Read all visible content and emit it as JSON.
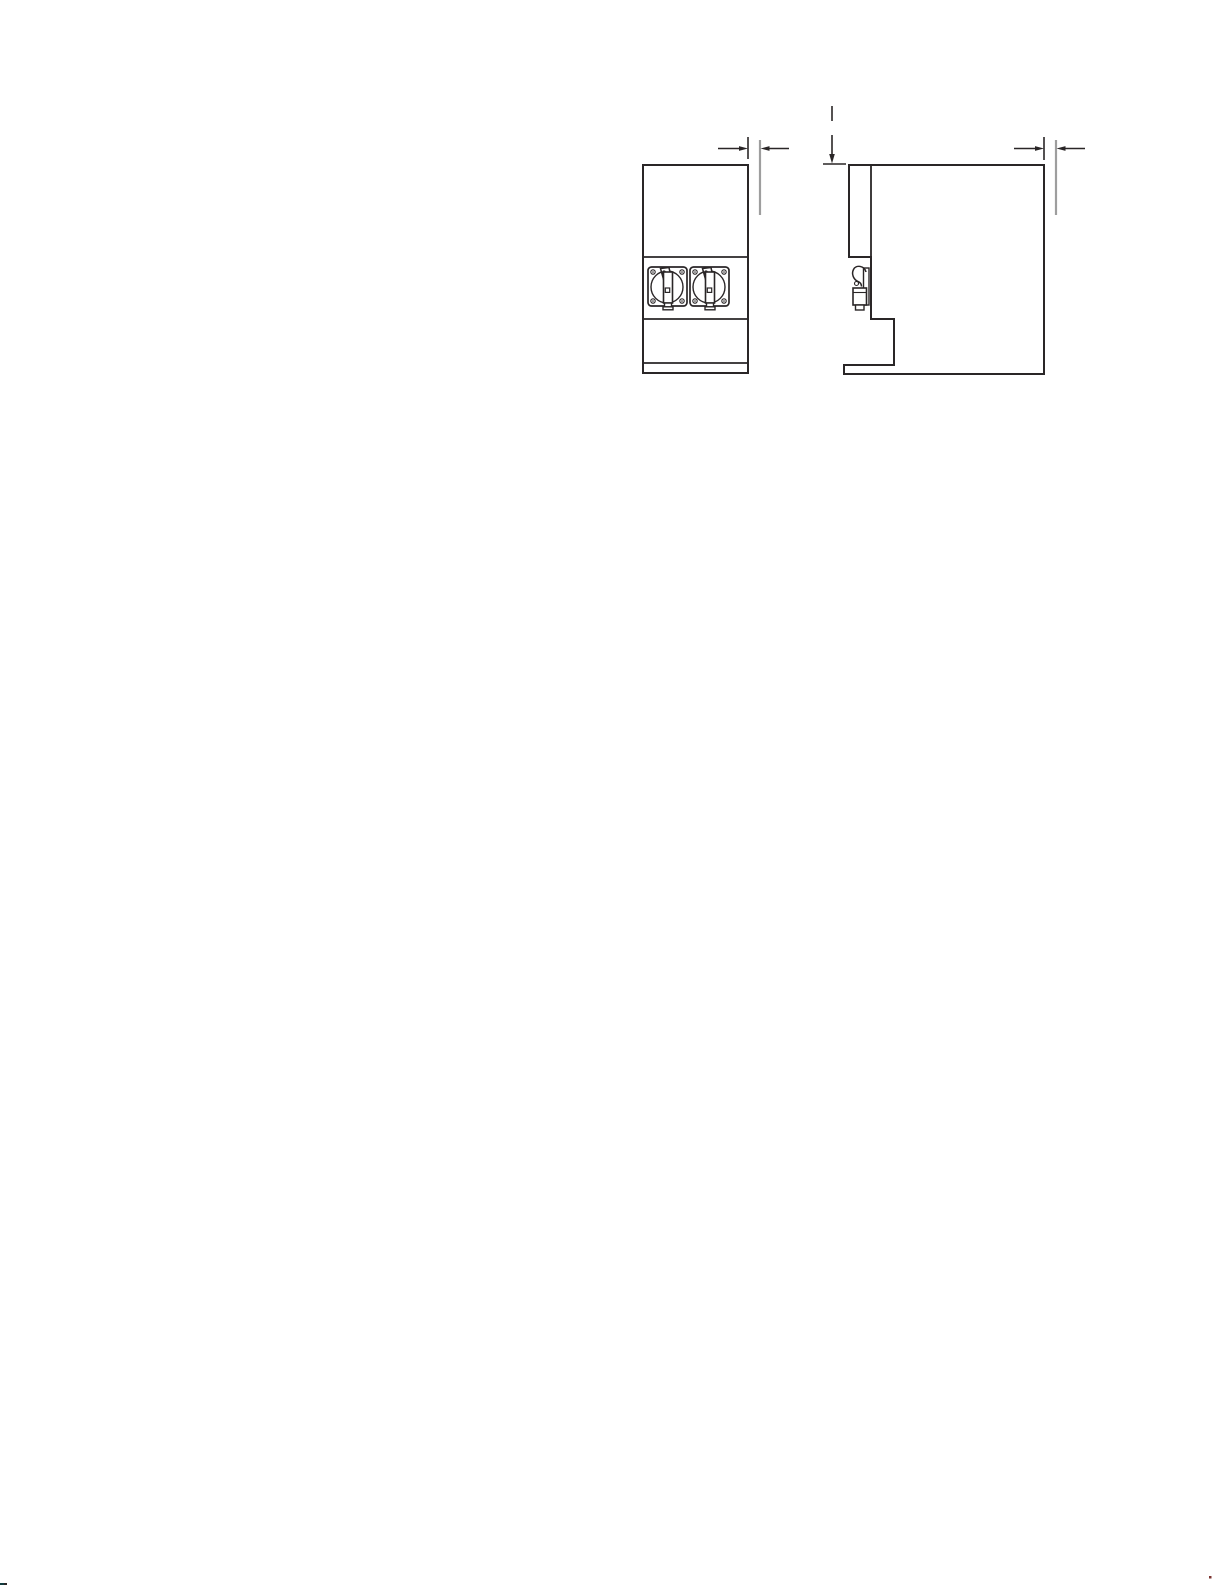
{
  "page": {
    "width": 1225,
    "height": 1585,
    "background": "#ffffff"
  },
  "drawing": {
    "ink": "#2a2627",
    "extension_gray": "#9e9e9e",
    "defs": {
      "valve": [
        {
          "t": "rect",
          "x": 0,
          "y": 0,
          "w": 39,
          "h": 39,
          "rx": 3.5,
          "f": "#ffffff",
          "sw": 1.7,
          "name": "valve-faceplate"
        },
        {
          "t": "circle",
          "cx": 19,
          "cy": 20,
          "r": 16,
          "f": "none",
          "sw": 1.4,
          "name": "valve-bezel"
        },
        {
          "t": "circle",
          "cx": 5,
          "cy": 5,
          "r": 2.2,
          "f": "none",
          "sw": 1.1,
          "name": "screw"
        },
        {
          "t": "circle",
          "cx": 34,
          "cy": 5,
          "r": 2.2,
          "f": "none",
          "sw": 1.1,
          "name": "screw"
        },
        {
          "t": "circle",
          "cx": 5,
          "cy": 34,
          "r": 2.2,
          "f": "none",
          "sw": 1.1,
          "name": "screw"
        },
        {
          "t": "circle",
          "cx": 34,
          "cy": 34,
          "r": 2.2,
          "f": "none",
          "sw": 1.1,
          "name": "screw"
        },
        {
          "t": "circle",
          "cx": 5,
          "cy": 5,
          "r": 0.8,
          "f": "#2a2627",
          "sw": 0,
          "name": "screw-dot"
        },
        {
          "t": "circle",
          "cx": 34,
          "cy": 5,
          "r": 0.8,
          "f": "#2a2627",
          "sw": 0,
          "name": "screw-dot"
        },
        {
          "t": "circle",
          "cx": 5,
          "cy": 34,
          "r": 0.8,
          "f": "#2a2627",
          "sw": 0,
          "name": "screw-dot"
        },
        {
          "t": "circle",
          "cx": 34,
          "cy": 34,
          "r": 0.8,
          "f": "#2a2627",
          "sw": 0,
          "name": "screw-dot"
        },
        {
          "t": "poly",
          "pts": "12.5,1.5 21,0.5 23.5,13 16,14",
          "f": "#ffffff",
          "sw": 1.5,
          "name": "valve-handle-lever"
        },
        {
          "t": "circle",
          "cx": 16,
          "cy": 5.5,
          "r": 1.6,
          "f": "#ffffff",
          "sw": 1.1,
          "name": "lever-hole"
        },
        {
          "t": "rect",
          "x": 15.5,
          "y": 5,
          "w": 9,
          "h": 31,
          "f": "#ffffff",
          "sw": 1.6,
          "name": "valve-handle-body"
        },
        {
          "t": "rect",
          "x": 17.3,
          "y": 21,
          "w": 4.4,
          "h": 4.4,
          "f": "none",
          "sw": 1.2,
          "name": "handle-detent"
        },
        {
          "t": "rect",
          "x": 16.5,
          "y": 36,
          "w": 7,
          "h": 4,
          "f": "#ffffff",
          "sw": 1.4,
          "name": "spout"
        },
        {
          "t": "rect",
          "x": 15,
          "y": 39.8,
          "w": 10,
          "h": 3,
          "f": "#ffffff",
          "sw": 1.4,
          "name": "spout-tip"
        }
      ]
    },
    "groups": [
      {
        "name": "front-view",
        "shapes": [
          {
            "t": "rect",
            "x": 643,
            "y": 165,
            "w": 105,
            "h": 208,
            "f": "none",
            "sw": 2,
            "name": "front-outline"
          },
          {
            "t": "line",
            "x1": 643,
            "y1": 257,
            "x2": 748,
            "y2": 257,
            "sw": 1.8,
            "name": "hopper-seam"
          },
          {
            "t": "line",
            "x1": 643,
            "y1": 319,
            "x2": 748,
            "y2": 319,
            "sw": 1.8,
            "name": "valve-panel-seam"
          },
          {
            "t": "line",
            "x1": 643,
            "y1": 363,
            "x2": 748,
            "y2": 363,
            "sw": 1.8,
            "name": "base-seam"
          }
        ]
      },
      {
        "name": "dispense-valve-front-left",
        "use": "valve",
        "translate": [
          648,
          267
        ]
      },
      {
        "name": "dispense-valve-front-right",
        "use": "valve",
        "translate": [
          690,
          267
        ]
      },
      {
        "name": "side-view",
        "shapes": [
          {
            "t": "path",
            "d": "M849,165 H1044 V374 H844 V365 H894 V319 H871 V257 H849 Z",
            "f": "none",
            "sw": 2,
            "name": "side-outline"
          },
          {
            "t": "line",
            "x1": 871,
            "y1": 165,
            "x2": 871,
            "y2": 257,
            "sw": 1.8,
            "name": "front-panel-edge"
          }
        ]
      },
      {
        "name": "dispense-valve-side",
        "shapes": [
          {
            "t": "rect",
            "x": 863.5,
            "y": 268,
            "w": 5.5,
            "h": 37,
            "f": "#ffffff",
            "sw": 1.4,
            "name": "valve-plate-profile"
          },
          {
            "t": "path",
            "d": "M866,272 C864.5,265.5 856,264.5 853.5,269.5 C851.2,274 853.5,279.5 858,281.5 C860.5,282.5 861.5,284 861.5,286.5",
            "f": "none",
            "sw": 1.5,
            "name": "valve-handle-profile"
          },
          {
            "t": "circle",
            "cx": 856.5,
            "cy": 283.5,
            "r": 2,
            "f": "none",
            "sw": 1.1,
            "name": "handle-knob"
          },
          {
            "t": "rect",
            "x": 853,
            "y": 288,
            "w": 13.5,
            "h": 17,
            "f": "#ffffff",
            "sw": 1.6,
            "name": "valve-body-profile"
          },
          {
            "t": "line",
            "x1": 853,
            "y1": 292.5,
            "x2": 866.5,
            "y2": 292.5,
            "sw": 1.1,
            "name": "valve-body-seam"
          },
          {
            "t": "rect",
            "x": 855.5,
            "y": 305,
            "w": 8.5,
            "h": 5,
            "f": "#ffffff",
            "sw": 1.4,
            "name": "spout-profile"
          }
        ]
      },
      {
        "name": "dimension-front-clearance",
        "shapes": [
          {
            "t": "line",
            "x1": 748,
            "y1": 137,
            "x2": 748,
            "y2": 159,
            "sw": 1.6,
            "name": "extension-line"
          },
          {
            "t": "line",
            "x1": 760,
            "y1": 140,
            "x2": 760,
            "y2": 215,
            "sw": 2.2,
            "c": "gray",
            "name": "extension-line-gray"
          },
          {
            "t": "line",
            "x1": 718,
            "y1": 148.5,
            "x2": 742,
            "y2": 148.5,
            "sw": 1.6,
            "name": "dimension-line"
          },
          {
            "t": "poly",
            "pts": "748,148.5 739,146.1 739,150.9",
            "f": "#2a2627",
            "sw": 0,
            "name": "arrow-right-icon"
          },
          {
            "t": "line",
            "x1": 766,
            "y1": 148.5,
            "x2": 789,
            "y2": 148.5,
            "sw": 1.6,
            "name": "dimension-line"
          },
          {
            "t": "poly",
            "pts": "760.5,148.5 769.5,146.1 769.5,150.9",
            "f": "#2a2627",
            "sw": 0,
            "name": "arrow-left-icon"
          }
        ]
      },
      {
        "name": "dimension-side-clearance",
        "shapes": [
          {
            "t": "line",
            "x1": 1044,
            "y1": 137,
            "x2": 1044,
            "y2": 160,
            "sw": 1.6,
            "name": "extension-line"
          },
          {
            "t": "line",
            "x1": 1056,
            "y1": 140,
            "x2": 1056,
            "y2": 215,
            "sw": 2.2,
            "c": "gray",
            "name": "extension-line-gray"
          },
          {
            "t": "line",
            "x1": 1014,
            "y1": 148.5,
            "x2": 1038,
            "y2": 148.5,
            "sw": 1.6,
            "name": "dimension-line"
          },
          {
            "t": "poly",
            "pts": "1044,148.5 1035,146.1 1035,150.9",
            "f": "#2a2627",
            "sw": 0,
            "name": "arrow-right-icon"
          },
          {
            "t": "line",
            "x1": 1062,
            "y1": 148.5,
            "x2": 1085,
            "y2": 148.5,
            "sw": 1.6,
            "name": "dimension-line"
          },
          {
            "t": "poly",
            "pts": "1056.5,148.5 1065.5,146.1 1065.5,150.9",
            "f": "#2a2627",
            "sw": 0,
            "name": "arrow-left-icon"
          }
        ]
      },
      {
        "name": "dimension-side-height",
        "shapes": [
          {
            "t": "line",
            "x1": 832,
            "y1": 106,
            "x2": 832,
            "y2": 121,
            "sw": 1.6,
            "name": "leader-line"
          },
          {
            "t": "line",
            "x1": 832,
            "y1": 135,
            "x2": 832,
            "y2": 155,
            "sw": 1.6,
            "name": "dimension-line"
          },
          {
            "t": "poly",
            "pts": "832,163.5 829.2,154 834.8,154",
            "f": "#2a2627",
            "sw": 0,
            "name": "arrow-down-icon"
          },
          {
            "t": "line",
            "x1": 823,
            "y1": 164,
            "x2": 846,
            "y2": 164,
            "sw": 1.6,
            "name": "datum-tick"
          }
        ]
      },
      {
        "name": "scan-artifacts",
        "shapes": [
          {
            "t": "rect",
            "x": 0,
            "y": 1583,
            "w": 4,
            "h": 2,
            "f": "#123c3f",
            "sw": 0,
            "name": "scan-artifact"
          },
          {
            "t": "rect",
            "x": 4,
            "y": 1583,
            "w": 3,
            "h": 2,
            "f": "#2a2627",
            "sw": 0,
            "name": "scan-artifact"
          },
          {
            "t": "rect",
            "x": 1209,
            "y": 1576,
            "w": 2.5,
            "h": 2.5,
            "f": "#7c3430",
            "sw": 0,
            "name": "scan-artifact"
          }
        ]
      }
    ]
  }
}
